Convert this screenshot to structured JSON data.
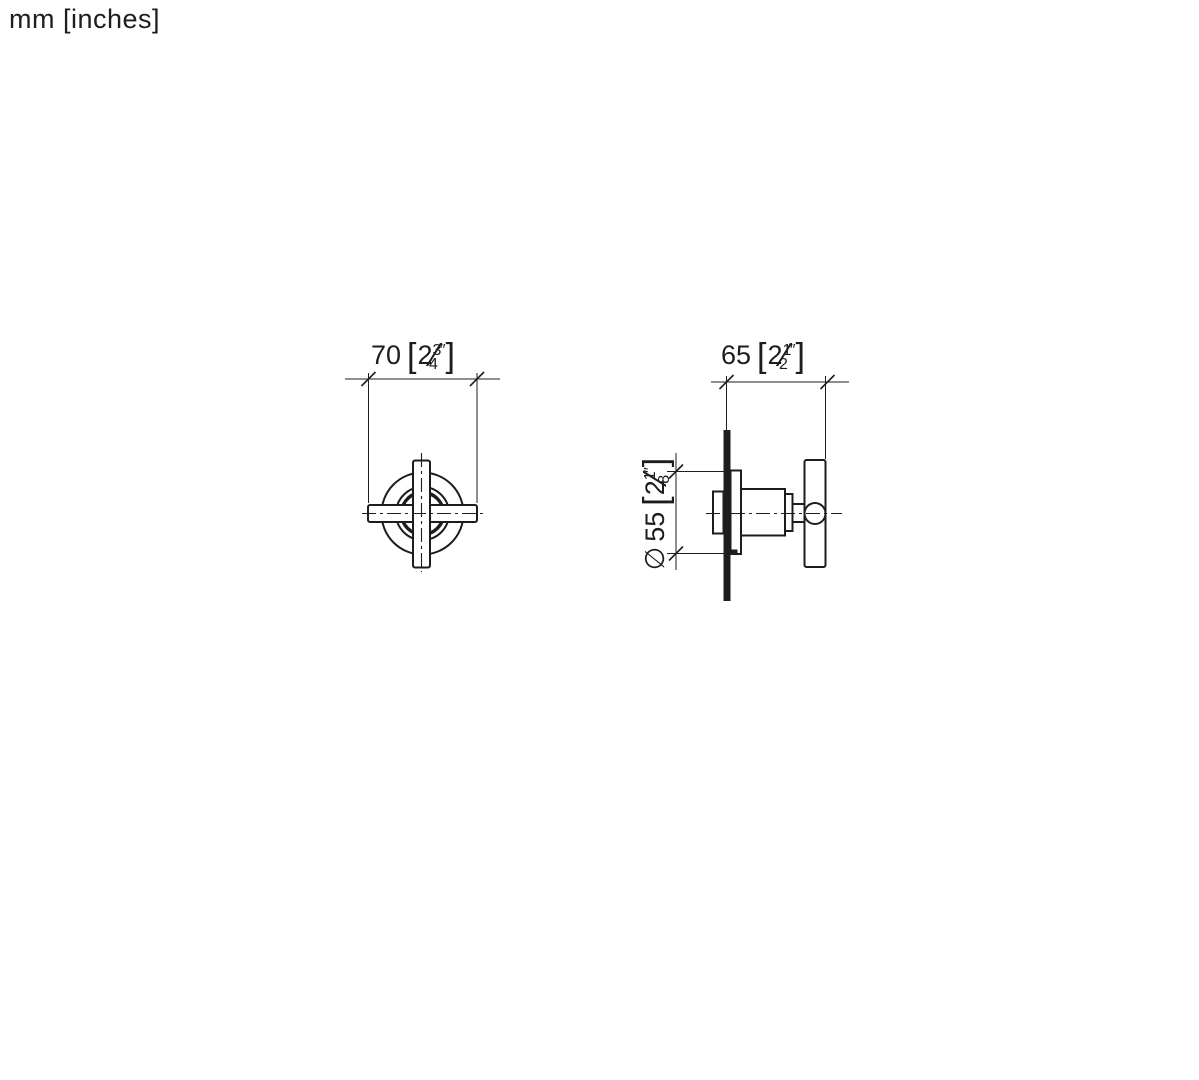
{
  "page": {
    "unit_note": "mm [inches]"
  },
  "symbols": {
    "bracket_open": "[",
    "bracket_close": "]",
    "inch_mark": "″",
    "fraction_slash": "⁄",
    "diameter_prefix": "∅"
  },
  "dimensions": {
    "front_width": {
      "mm": "70",
      "inch_whole": "2",
      "inch_num": "3",
      "inch_den": "4"
    },
    "side_depth": {
      "mm": "65",
      "inch_whole": "2",
      "inch_num": "1",
      "inch_den": "2"
    },
    "rosette_diameter": {
      "mm": "55",
      "inch_whole": "2",
      "inch_num": "1",
      "inch_den": "8"
    }
  },
  "colors": {
    "line": "#1d1d1b",
    "background": "#ffffff"
  }
}
